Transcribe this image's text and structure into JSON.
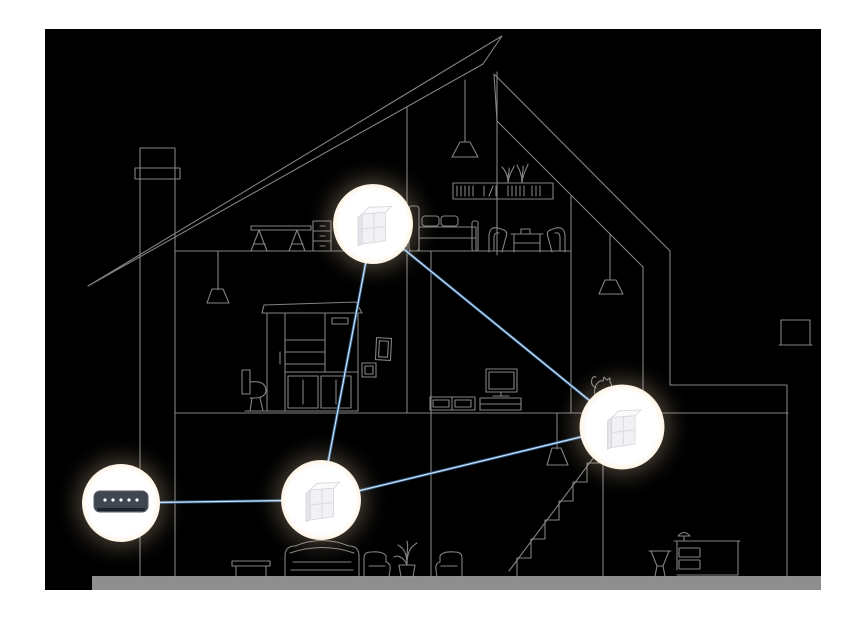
{
  "meta": {
    "description": "Cross-section line drawing of a two-story house with attic showing a whole-home mesh Wi-Fi system: a modem connected to three mesh cube nodes by blue links",
    "page_background": "#ffffff",
    "canvas_background": "#000000"
  },
  "palette": {
    "line_art": "#9a9a9a",
    "ground_bar": "#8e8e8e",
    "link_glow": "#2e5e8e",
    "link_core": "#d8ebfb",
    "halo_rim": "#c4905f",
    "cube_face": "#f2f2f6",
    "modem_body": "#40464f",
    "modem_led": "#ffffff"
  },
  "network": {
    "devices": [
      {
        "id": "modem",
        "type": "modem",
        "name": "modem-router",
        "x": 121,
        "y": 503,
        "r": 33
      },
      {
        "id": "node-attic",
        "type": "mesh-node",
        "name": "mesh-node-attic",
        "x": 373,
        "y": 224,
        "r": 34
      },
      {
        "id": "node-ground",
        "type": "mesh-node",
        "name": "mesh-node-ground-floor",
        "x": 321,
        "y": 500,
        "r": 34
      },
      {
        "id": "node-right",
        "type": "mesh-node",
        "name": "mesh-node-stairwell",
        "x": 622,
        "y": 427,
        "r": 36
      }
    ],
    "links": [
      [
        "modem",
        "node-ground"
      ],
      [
        "node-ground",
        "node-attic"
      ],
      [
        "node-attic",
        "node-right"
      ],
      [
        "node-ground",
        "node-right"
      ]
    ],
    "modem_led_count": 5
  },
  "house_items": [
    "roof",
    "chimney",
    "attic-pendant-lamp",
    "attic-desk",
    "attic-drawer-unit",
    "bookshelf-with-plants",
    "double-bed",
    "dining-chairs-and-table",
    "pendant-lamp-middle",
    "toilet",
    "wardrobe-cabinet",
    "wall-pictures",
    "tv-and-console",
    "sideboard",
    "cat",
    "dining-pendant-lamp",
    "coffee-table",
    "sofa",
    "armchair-left",
    "potted-plant",
    "armchair-right",
    "stairs-pendant-lamp",
    "staircase",
    "annex-stool",
    "annex-desk-with-lamp",
    "annex-window",
    "ground-bar"
  ]
}
